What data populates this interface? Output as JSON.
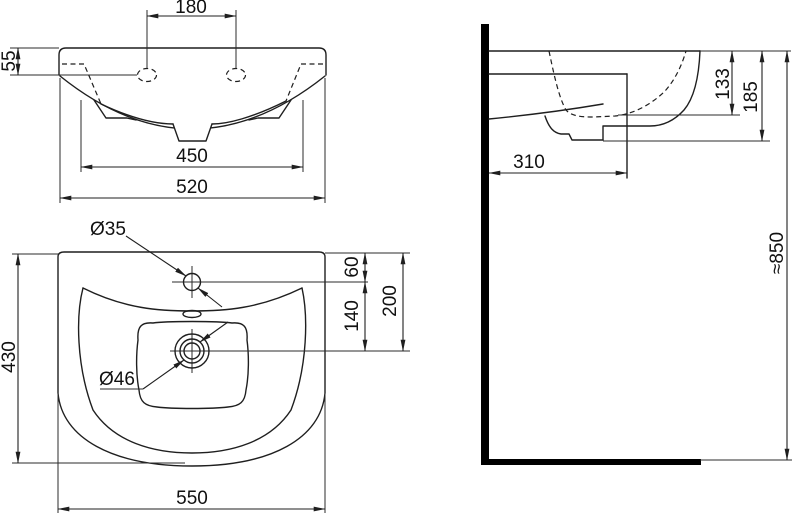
{
  "colors": {
    "line": "#1f1f1f",
    "wall": "#000000",
    "background": "#ffffff"
  },
  "front_view": {
    "hole_spacing": "180",
    "rim_height": "55",
    "bowl_width": "450",
    "overall_width": "520"
  },
  "plan_view": {
    "faucet_hole_diameter": "Ø35",
    "faucet_offset": "60",
    "faucet_to_drain": "140",
    "back_to_drain": "200",
    "overall_depth": "430",
    "drain_diameter": "Ø46",
    "overall_width": "550"
  },
  "side_view": {
    "bowl_depth": "133",
    "front_height": "185",
    "wall_projection": "310",
    "mounting_height": "≈850"
  }
}
